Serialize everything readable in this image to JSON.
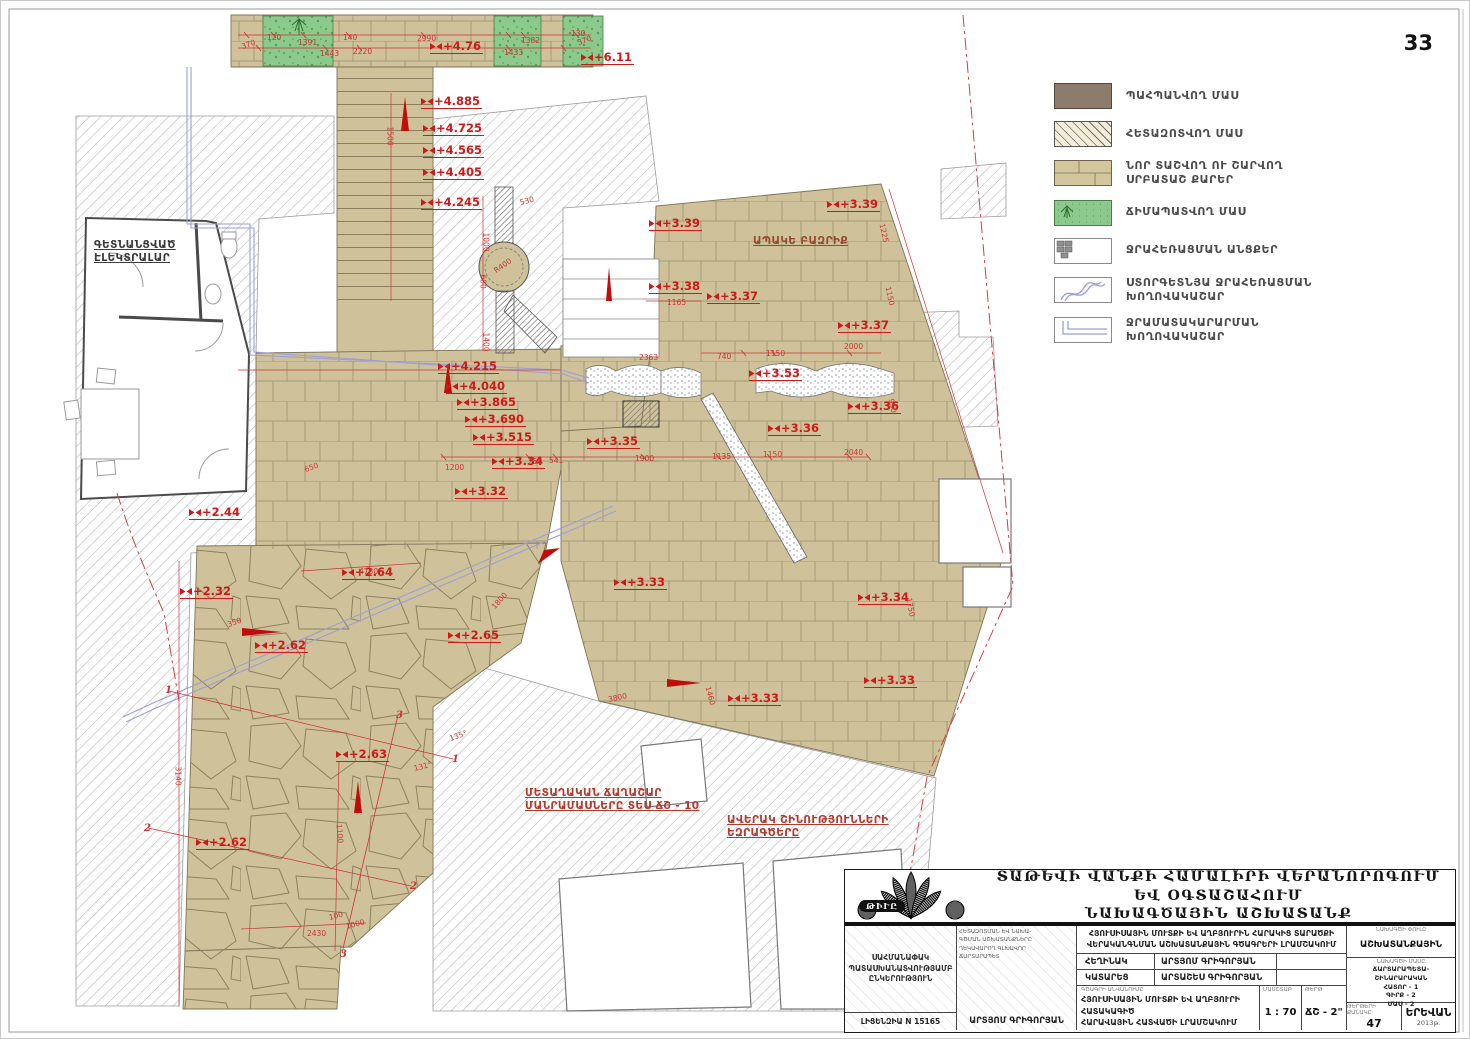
{
  "sheet": {
    "number": "33"
  },
  "legend": {
    "items": [
      {
        "name": "preserved-part",
        "swatch": "solid-brown",
        "label": "ՊԱՀՊԱՆՎՈՂ ՄԱՍ"
      },
      {
        "name": "investigated-part",
        "swatch": "hatch",
        "label": "ՀԵՏԱԶՈՏՎՈՂ ՄԱՍ"
      },
      {
        "name": "new-hewn-stones",
        "swatch": "stones",
        "label": "ՆՈՐ ՏԱՇՎՈՂ ՈՒ ՇԱՐՎՈՂ\nՍՐԲԱՏԱՇ ՔԱՐԵՐ"
      },
      {
        "name": "turfed-part",
        "swatch": "grass",
        "label": "ՃԻՄԱՊԱՏՎՈՂ ՄԱՍ"
      },
      {
        "name": "drainage-openings",
        "swatch": "drain",
        "label": "ՋՐԱՀԵՌԱՑՄԱՆ ԱՆՑՔԵՐ"
      },
      {
        "name": "underground-drainage-pipeline",
        "swatch": "pipe-wavy",
        "label": "ՍՏՈՐԳԵՏՆՅԱ ՋՐԱՀԵՌԱՑՄԱՆ\nԽՈՂՈՎԱԿԱՇԱՐ"
      },
      {
        "name": "water-supply-pipeline",
        "swatch": "pipe-angular",
        "label": "ՋՐԱՄԱՏԱԿԱՐԱՐՄԱՆ\nԽՈՂՈՎԱԿԱՇԱՐ"
      }
    ]
  },
  "plan": {
    "labels": [
      {
        "lines": [
          "ԳԵՏՆԱՆՑՎԱԾ",
          "ԷԼԵԿՏՐԱԼԱՐ"
        ],
        "x": 93,
        "y": 238,
        "color": "#3a3a3a"
      },
      {
        "lines": [
          "ԱՊԱԿԵ ԲԱԶՐԻՔ"
        ],
        "x": 752,
        "y": 234,
        "color": "#96492f"
      },
      {
        "lines": [
          "ՄԵՏԱՂԱԿԱՆ ՃԱՂԱՇԱՐ",
          "ՄԱՆՐԱՄԱՍՆԵՐԸ ՏԵՍ ՃՇ - 10"
        ],
        "x": 524,
        "y": 786,
        "color": "#b03a2e"
      },
      {
        "lines": [
          "ԱՎԵՐԱԿ ՇԻՆՈՒԹՅՈՒՆՆԵՐԻ",
          "ԵԶՐԱԳԾԵՐԸ"
        ],
        "x": 726,
        "y": 813,
        "color": "#b03a2e"
      }
    ],
    "markers": [
      {
        "v": "+4.76",
        "x": 443,
        "y": 52
      },
      {
        "v": "+6.11",
        "x": 594,
        "y": 63
      },
      {
        "v": "+4.885",
        "x": 434,
        "y": 107
      },
      {
        "v": "+4.725",
        "x": 436,
        "y": 134
      },
      {
        "v": "+4.565",
        "x": 436,
        "y": 156
      },
      {
        "v": "+4.405",
        "x": 436,
        "y": 178
      },
      {
        "v": "+4.245",
        "x": 434,
        "y": 208
      },
      {
        "v": "+4.215",
        "x": 451,
        "y": 372
      },
      {
        "v": "+4.040",
        "x": 459,
        "y": 392
      },
      {
        "v": "+3.865",
        "x": 470,
        "y": 408
      },
      {
        "v": "+3.690",
        "x": 478,
        "y": 425
      },
      {
        "v": "+3.515",
        "x": 486,
        "y": 443
      },
      {
        "v": "+3.39",
        "x": 662,
        "y": 229
      },
      {
        "v": "+3.39",
        "x": 840,
        "y": 210
      },
      {
        "v": "+3.38",
        "x": 662,
        "y": 292
      },
      {
        "v": "+3.37",
        "x": 720,
        "y": 302
      },
      {
        "v": "+3.37",
        "x": 851,
        "y": 331
      },
      {
        "v": "+3.53",
        "x": 762,
        "y": 379
      },
      {
        "v": "+3.36",
        "x": 861,
        "y": 412
      },
      {
        "v": "+3.36",
        "x": 781,
        "y": 434
      },
      {
        "v": "+3.35",
        "x": 600,
        "y": 447
      },
      {
        "v": "+3.34",
        "x": 505,
        "y": 467
      },
      {
        "v": "+3.32",
        "x": 468,
        "y": 497
      },
      {
        "v": "+2.44",
        "x": 202,
        "y": 518
      },
      {
        "v": "+2.32",
        "x": 193,
        "y": 597
      },
      {
        "v": "+2.64",
        "x": 355,
        "y": 578
      },
      {
        "v": "+2.62",
        "x": 268,
        "y": 651
      },
      {
        "v": "+2.65",
        "x": 461,
        "y": 641
      },
      {
        "v": "+3.33",
        "x": 627,
        "y": 588
      },
      {
        "v": "+3.34",
        "x": 871,
        "y": 603
      },
      {
        "v": "+3.33",
        "x": 877,
        "y": 686
      },
      {
        "v": "+3.33",
        "x": 741,
        "y": 704
      },
      {
        "v": "+2.63",
        "x": 349,
        "y": 760
      },
      {
        "v": "+2.62",
        "x": 209,
        "y": 848
      }
    ],
    "dims": [
      {
        "t": "370",
        "x": 242,
        "y": 42,
        "r": -20
      },
      {
        "t": "120",
        "x": 266,
        "y": 33,
        "r": 0
      },
      {
        "t": "1391",
        "x": 297,
        "y": 38,
        "r": 0
      },
      {
        "t": "140",
        "x": 342,
        "y": 33,
        "r": 0
      },
      {
        "t": "2990",
        "x": 416,
        "y": 34,
        "r": 0
      },
      {
        "t": "2220",
        "x": 352,
        "y": 47,
        "r": 0
      },
      {
        "t": "1443",
        "x": 319,
        "y": 49,
        "r": 0
      },
      {
        "t": "1433",
        "x": 503,
        "y": 48,
        "r": 0
      },
      {
        "t": "1382",
        "x": 520,
        "y": 36,
        "r": 0
      },
      {
        "t": "130",
        "x": 570,
        "y": 29,
        "r": 0
      },
      {
        "t": "370",
        "x": 578,
        "y": 38,
        "r": -20
      },
      {
        "t": "1500",
        "x": 385,
        "y": 118,
        "r": 90
      },
      {
        "t": "530",
        "x": 520,
        "y": 198,
        "r": -15
      },
      {
        "t": "1000",
        "x": 481,
        "y": 224,
        "r": 90
      },
      {
        "t": "600",
        "x": 478,
        "y": 266,
        "r": 90
      },
      {
        "t": "1400",
        "x": 481,
        "y": 324,
        "r": 90
      },
      {
        "t": "R400",
        "x": 496,
        "y": 266,
        "r": -35
      },
      {
        "t": "2363",
        "x": 638,
        "y": 353,
        "r": 0
      },
      {
        "t": "1165",
        "x": 666,
        "y": 298,
        "r": 0
      },
      {
        "t": "740",
        "x": 716,
        "y": 352,
        "r": 0
      },
      {
        "t": "1150",
        "x": 765,
        "y": 349,
        "r": 0
      },
      {
        "t": "2000",
        "x": 843,
        "y": 342,
        "r": 0
      },
      {
        "t": "1225",
        "x": 877,
        "y": 216,
        "r": 78
      },
      {
        "t": "1150",
        "x": 883,
        "y": 279,
        "r": 78
      },
      {
        "t": "950",
        "x": 886,
        "y": 391,
        "r": 78
      },
      {
        "t": "1200",
        "x": 444,
        "y": 463,
        "r": 0
      },
      {
        "t": "250",
        "x": 527,
        "y": 457,
        "r": 0
      },
      {
        "t": "541",
        "x": 548,
        "y": 456,
        "r": 0
      },
      {
        "t": "1900",
        "x": 634,
        "y": 454,
        "r": 0
      },
      {
        "t": "1135",
        "x": 711,
        "y": 452,
        "r": 0
      },
      {
        "t": "1150",
        "x": 762,
        "y": 450,
        "r": 0
      },
      {
        "t": "2040",
        "x": 843,
        "y": 448,
        "r": 0
      },
      {
        "t": "650",
        "x": 305,
        "y": 465,
        "r": -20
      },
      {
        "t": "4730",
        "x": 358,
        "y": 567,
        "r": 0
      },
      {
        "t": "1800",
        "x": 495,
        "y": 602,
        "r": -48
      },
      {
        "t": "350",
        "x": 228,
        "y": 620,
        "r": -20
      },
      {
        "t": "3140",
        "x": 173,
        "y": 758,
        "r": 90
      },
      {
        "t": "1100",
        "x": 334,
        "y": 816,
        "r": 85
      },
      {
        "t": "2430",
        "x": 306,
        "y": 929,
        "r": 0
      },
      {
        "t": "100",
        "x": 329,
        "y": 913,
        "r": -15
      },
      {
        "t": "1000",
        "x": 346,
        "y": 922,
        "r": -15
      },
      {
        "t": "1750",
        "x": 904,
        "y": 590,
        "r": 80
      },
      {
        "t": "3800",
        "x": 608,
        "y": 695,
        "r": -12
      },
      {
        "t": "1460",
        "x": 703,
        "y": 679,
        "r": 75
      },
      {
        "t": "135°",
        "x": 450,
        "y": 734,
        "r": -20
      },
      {
        "t": "131°",
        "x": 414,
        "y": 764,
        "r": -15
      }
    ],
    "sections": [
      {
        "t": "1",
        "x": 164,
        "y": 684
      },
      {
        "t": "1",
        "x": 451,
        "y": 753
      },
      {
        "t": "2",
        "x": 143,
        "y": 822
      },
      {
        "t": "2",
        "x": 409,
        "y": 880
      },
      {
        "t": "3",
        "x": 395,
        "y": 709
      },
      {
        "t": "3",
        "x": 339,
        "y": 948
      }
    ]
  },
  "titleblock": {
    "logo_text": "ԹԻՒԸ",
    "project_title": "ՏԱԹԵՎԻ ՎԱՆՔԻ ՀԱՄԱԼԻՐԻ ՎԵՐԱՆՈՐՈԳՈՒՄ ԵՎ ՕԳՏԱՇԱՀՈՒՄ\nՆԱԽԱԳԾԱՅԻՆ ԱՇԽԱՏԱՆՔ",
    "org_name": "ՍԱՀՄԱՆԱՓԱԿ ՊԱՏԱՍԽԱՆԱՏՎՈՒԹՅԱՄԲ ԸՆԿԵՐՈՒԹՅՈՒՆ",
    "license": "ԼԻՑԵՆԶԻԱ N 15165",
    "chief_note": "ՀԵՏԱԶՈՏՄԱՆ ԵՎ ՆԱԽԱ-\nԳԾՄԱՆ ԱՇԽԱՏԱՆՔՆԵՐԸ\nՂԵԿԱՎԱՐՈՂ ԳԼԽԱՎՈՐ\nՃԱՐՏԱՐԱՊԵՏ",
    "chief_name": "ԱՐՏՅՈՄ ԳՐԻԳՈՐՅԱՆ",
    "header": "ՀՅՈՒՍԻՍԱՅԻՆ ՄՈՒՏՔԻ ԵՎ ԱՂԲՅՈՒՐԻՆ ՀԱՐԱԿԻՑ ՏԱՐԱԾՔԻ ՎԵՐԱԿԱՆԳՆՄԱՆ ԱՇԽԱՏԱՆՔԱՅԻՆ ԳԾԱԳՐԵՐԻ ԼՐԱՄՇԱԿՈՒՄ",
    "author_label": "ՀԵՂԻՆԱԿ",
    "author_name": "ԱՐՏՅՈՄ ԳՐԻԳՈՐՅԱՆ",
    "performed_label": "ԿԱՏԱՐԵՑ",
    "performed_name": "ԱՐՏԱՇԵՍ ԳՐԻԳՈՐՅԱՆ",
    "drawing_label": "ԳԾԱԳՐԻ ԱՆՎԱՆՈՒՄԸ",
    "drawing_title": "ՀՅՈՒՍԻՍԱՅԻՆ ՄՈՒՏՔԻ ԵՎ ԱՂԲՅՈՒՐԻ\nՀԱՏԱԿԱԳԻԾ\nՀԱՐԱՎԱՅԻՆ ՀԱՏՎԱԾԻ ԼՐԱՄՇԱԿՈՒՄ",
    "scale_label": "ՄԱՍՇՏԱԲ",
    "scale_value": "1 : 70",
    "sheet_label": "ԹԵՐԹ",
    "sheet_code": "ՃՇ - 2\"",
    "stage_label": "ՆԱԽԱԳԾԻ ՓՈՒԼԸ",
    "stage_value": "ԱՇԽԱՏԱՆՔԱՅԻՆ",
    "part_label": "ՆԱԽԱԳԾԻ ՄԱՍԸ",
    "part_lines": "ՃԱՐՏԱՐԱՊԵՏԱ-\nՇԻՆԱՐԱՐԱԿԱՆ\nՀԱՏՈՐ - 1\nԳԻՐՔ - 2\nՄԱՍ - 2",
    "sheets_label": "ԹԵՐԹԵՐԻ ՔԱՆԱԿԸ",
    "sheets_count": "47",
    "city": "ԵՐԵՎԱՆ",
    "year": "2013թ."
  },
  "colors": {
    "stone_tan": "#cfc29a",
    "annotation_red": "#cc2222",
    "pipe_blue": "#9b9fd6",
    "grass_green": "#8cc98c",
    "preserved_brown": "#8d7b6b"
  }
}
